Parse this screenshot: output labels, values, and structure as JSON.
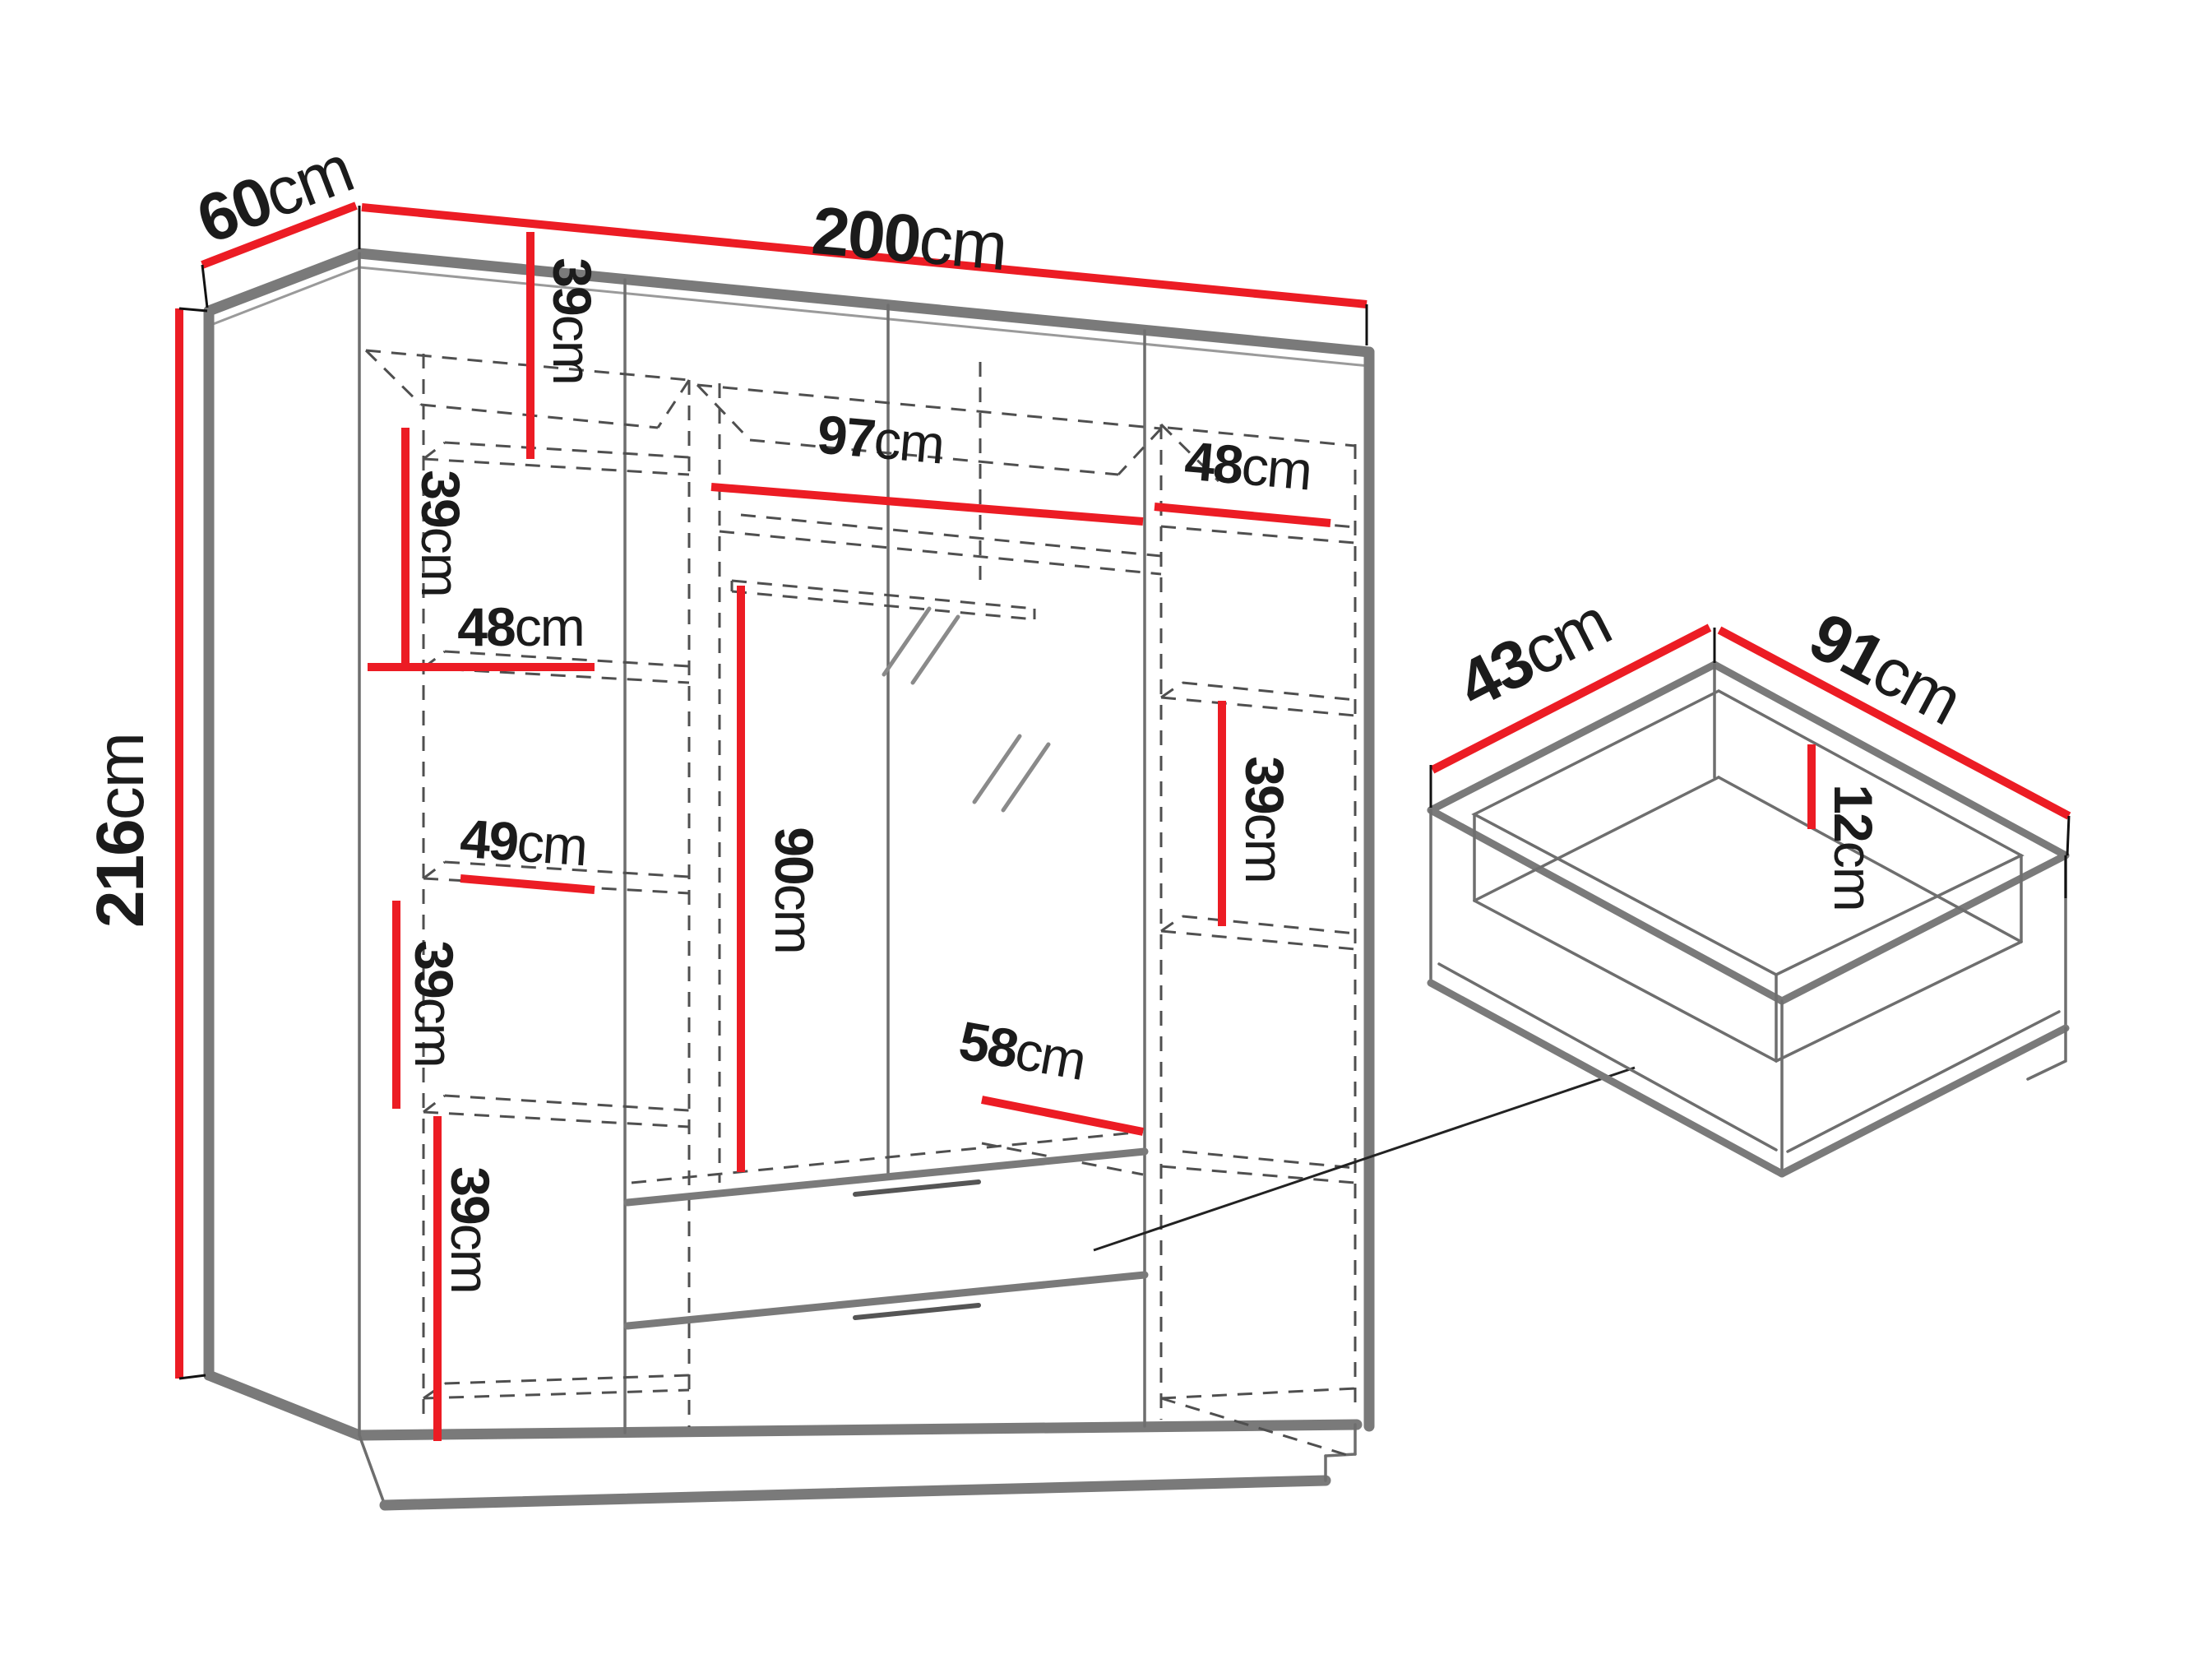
{
  "colors": {
    "dimension": "#ec1c24",
    "edges": "#7a7a7a",
    "thin": "#6e6e6e",
    "dashes": "#4f4f4f",
    "text": "#1b1b1b",
    "background": "#ffffff"
  },
  "wardrobe": {
    "width": {
      "n": "200",
      "u": "cm"
    },
    "depth": {
      "n": "60",
      "u": "cm"
    },
    "height": {
      "n": "216",
      "u": "cm"
    },
    "interior": {
      "top_mid_39": {
        "n": "39",
        "u": "cm"
      },
      "left_upper_39": {
        "n": "39",
        "u": "cm"
      },
      "left_shelf_48": {
        "n": "48",
        "u": "cm"
      },
      "mid_shelf_97": {
        "n": "97",
        "u": "cm"
      },
      "right_shelf_48": {
        "n": "48",
        "u": "cm"
      },
      "left_shelf_49": {
        "n": "49",
        "u": "cm"
      },
      "mid_hang_90": {
        "n": "90",
        "u": "cm"
      },
      "left_lower_39": {
        "n": "39",
        "u": "cm"
      },
      "left_bottom_39": {
        "n": "39",
        "u": "cm"
      },
      "right_39": {
        "n": "39",
        "u": "cm"
      },
      "drawer_width_58": {
        "n": "58",
        "u": "cm"
      }
    }
  },
  "drawer": {
    "depth": {
      "n": "43",
      "u": "cm"
    },
    "width": {
      "n": "91",
      "u": "cm"
    },
    "height": {
      "n": "12",
      "u": "cm"
    }
  }
}
